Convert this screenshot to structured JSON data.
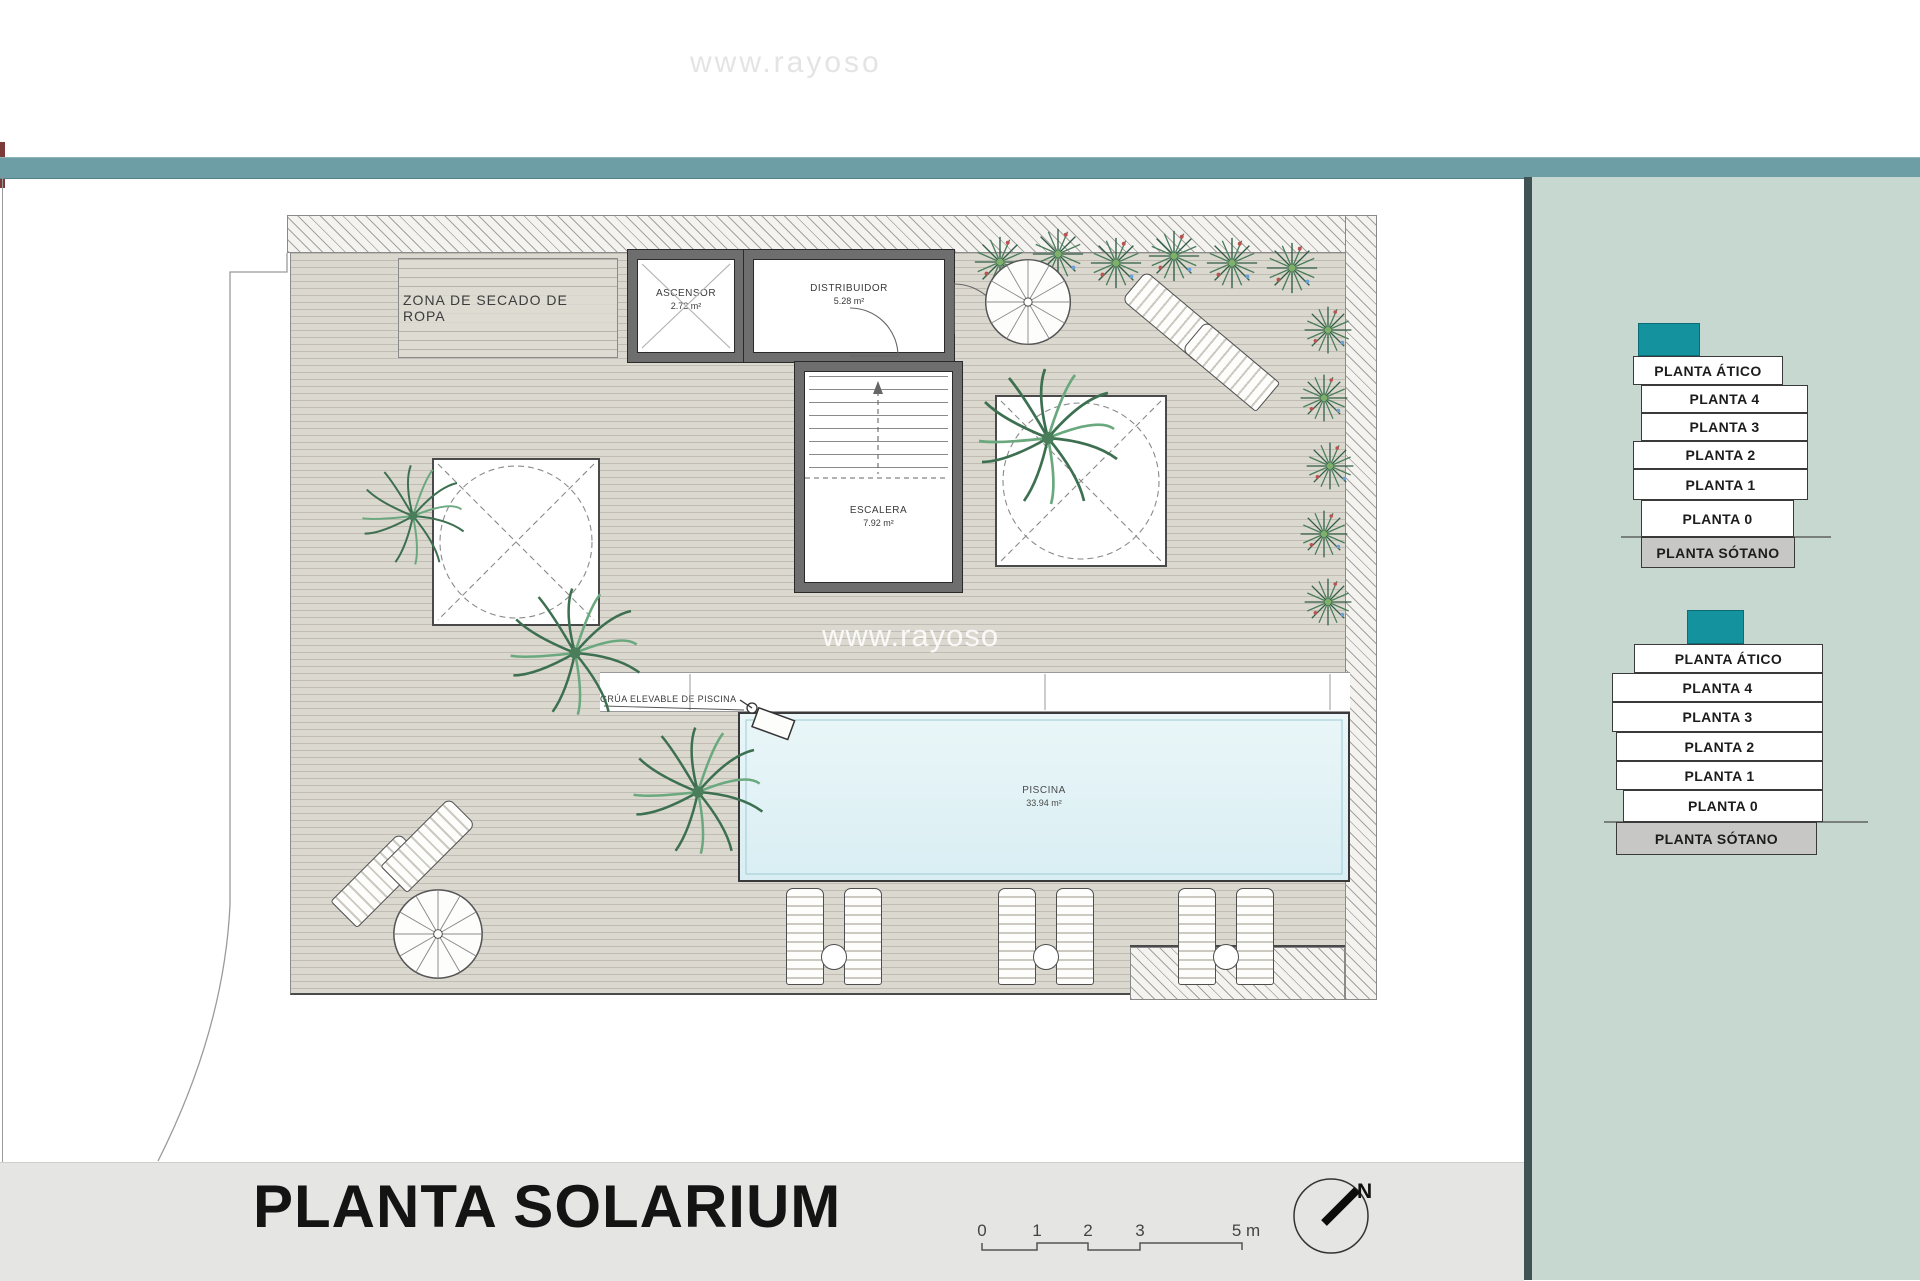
{
  "watermark": {
    "top": "www.rayoso",
    "plan": "www.rayoso"
  },
  "title_block": {
    "title": "PLANTA SOLARIUM",
    "scale_labels": [
      "0",
      "1",
      "2",
      "3",
      "5 m"
    ],
    "north_label": "N"
  },
  "plan": {
    "zona_secado_label": "ZONA DE SECADO DE ROPA",
    "ascensor": {
      "name": "ASCENSOR",
      "area": "2.72 m²"
    },
    "distribuidor": {
      "name": "DISTRIBUIDOR",
      "area": "5.28 m²"
    },
    "escalera": {
      "name": "ESCALERA",
      "area": "7.92 m²"
    },
    "piscina": {
      "name": "PISCINA",
      "area": "33.94 m²"
    },
    "grua_label": "GRÚA ELEVABLE DE PISCINA"
  },
  "stacks": [
    {
      "levels": [
        "PLANTA ÁTICO",
        "PLANTA 4",
        "PLANTA 3",
        "PLANTA 2",
        "PLANTA 1",
        "PLANTA 0",
        "PLANTA SÓTANO"
      ]
    },
    {
      "levels": [
        "PLANTA ÁTICO",
        "PLANTA 4",
        "PLANTA 3",
        "PLANTA 2",
        "PLANTA 1",
        "PLANTA 0",
        "PLANTA SÓTANO"
      ]
    }
  ],
  "colors": {
    "accent_teal": "#14929e",
    "topbar_teal": "#6d9da5",
    "panel_green": "#c6d8cf",
    "sotano_gray": "#c7c7c5",
    "pool_blue": "#dfeff4"
  }
}
